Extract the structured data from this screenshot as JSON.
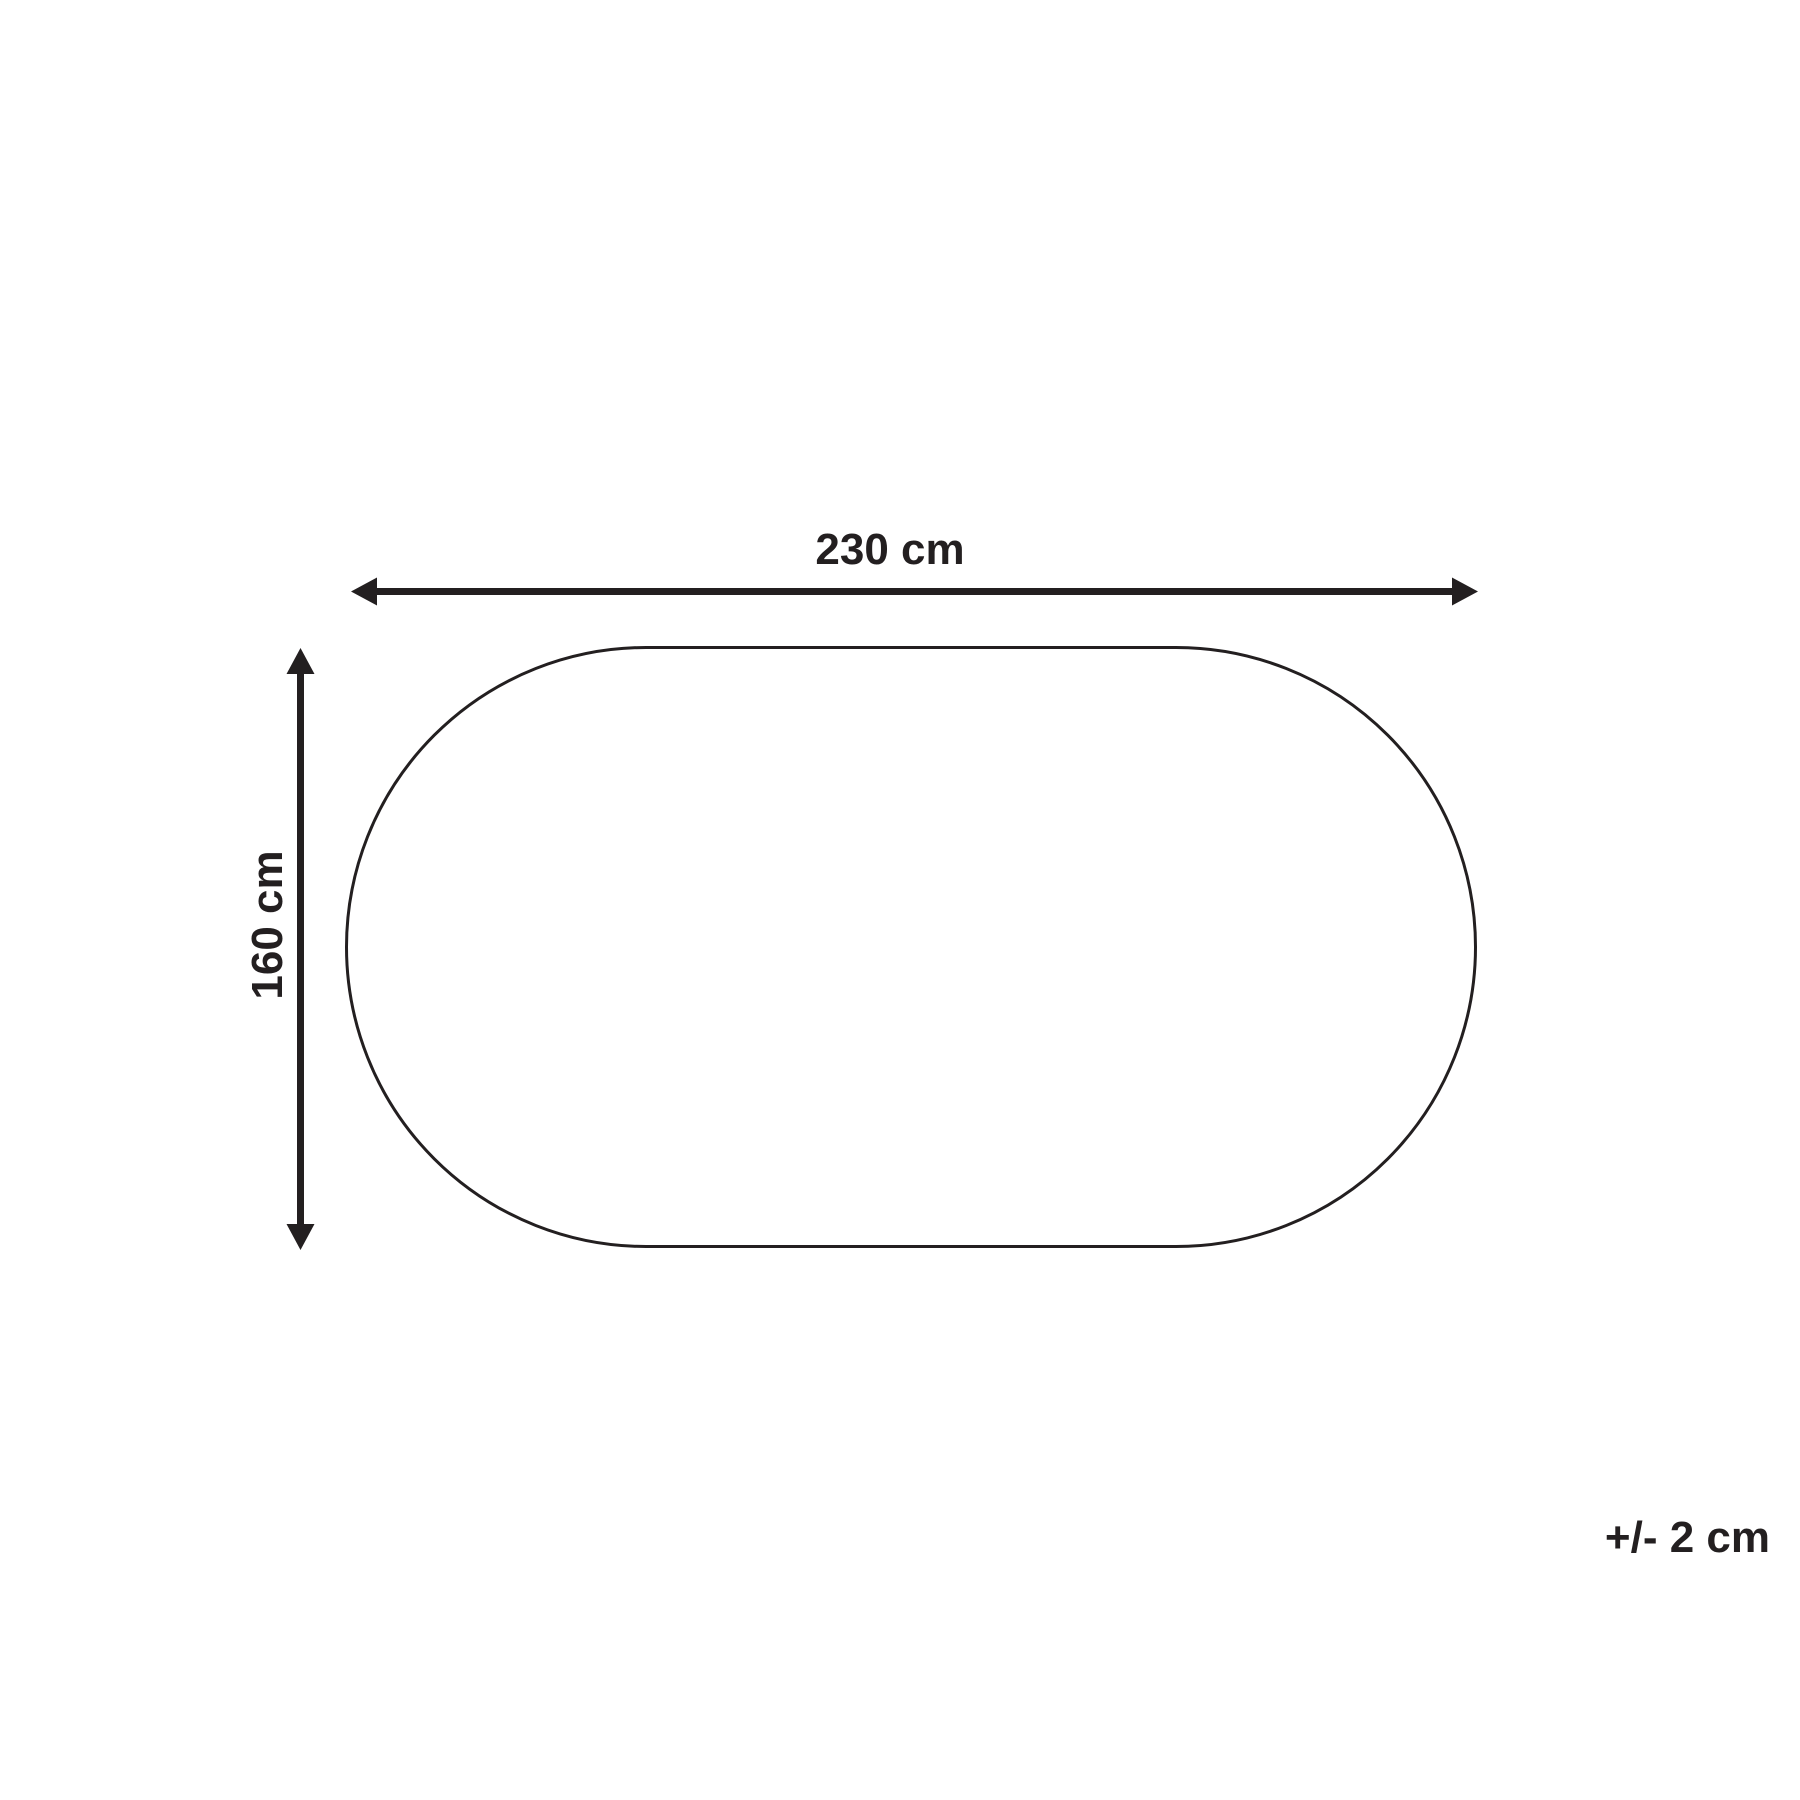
{
  "diagram": {
    "type": "product-dimension-diagram",
    "shape": "stadium-oval",
    "line_color": "#231f20",
    "background_color": "#ffffff",
    "width_label": "230 cm",
    "height_label": "160 cm",
    "tolerance_label": "+/- 2 cm",
    "dimensions": {
      "width_cm": 230,
      "height_cm": 160,
      "tolerance_cm": 2
    }
  }
}
